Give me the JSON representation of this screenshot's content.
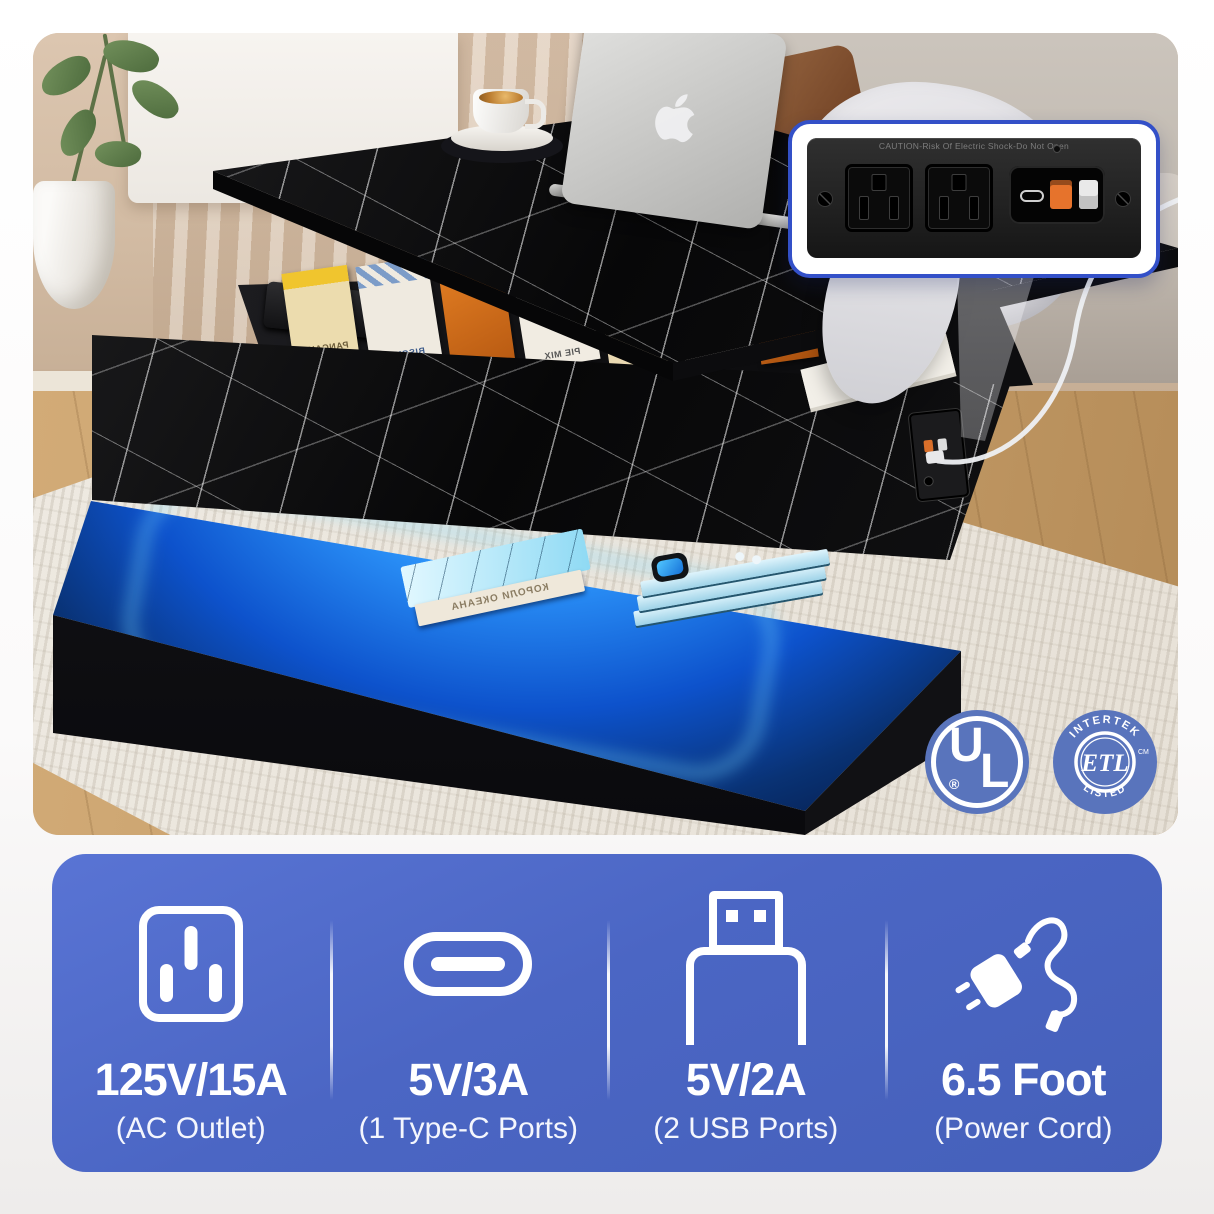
{
  "photo": {
    "inset_callout": {
      "caution_text": "CAUTION-Risk Of Electric Shock-Do Not Open",
      "border_color": "#3350c8",
      "ports": [
        "ac-outlet",
        "ac-outlet",
        "type-c-port",
        "usb-a-port-orange",
        "usb-a-port-white"
      ]
    },
    "storage_boxes": {
      "labels": [
        "PANCAKE MIX",
        "BISCUIT",
        "PIE MIX"
      ]
    },
    "led_base": {
      "book_spine_text": "КОРОЛИ ОКЕАНА",
      "glow_color": "#1f7ef0"
    },
    "badges": {
      "ul": {
        "letter_u": "U",
        "letter_l": "L",
        "mark": "®"
      },
      "etl": {
        "arc_top": "INTERTEK",
        "center": "ETL",
        "arc_bottom": "LISTED",
        "mark": "CM"
      },
      "badge_color": "#5974bc"
    }
  },
  "specs": {
    "panel_color": "#4b66c4",
    "items": [
      {
        "icon": "ac-outlet-icon",
        "value": "125V/15A",
        "label": "(AC Outlet)"
      },
      {
        "icon": "type-c-icon",
        "value": "5V/3A",
        "label": "(1 Type-C Ports)"
      },
      {
        "icon": "usb-icon",
        "value": "5V/2A",
        "label": "(2 USB Ports)"
      },
      {
        "icon": "power-cord-icon",
        "value": "6.5 Foot",
        "label": "(Power Cord)"
      }
    ]
  }
}
